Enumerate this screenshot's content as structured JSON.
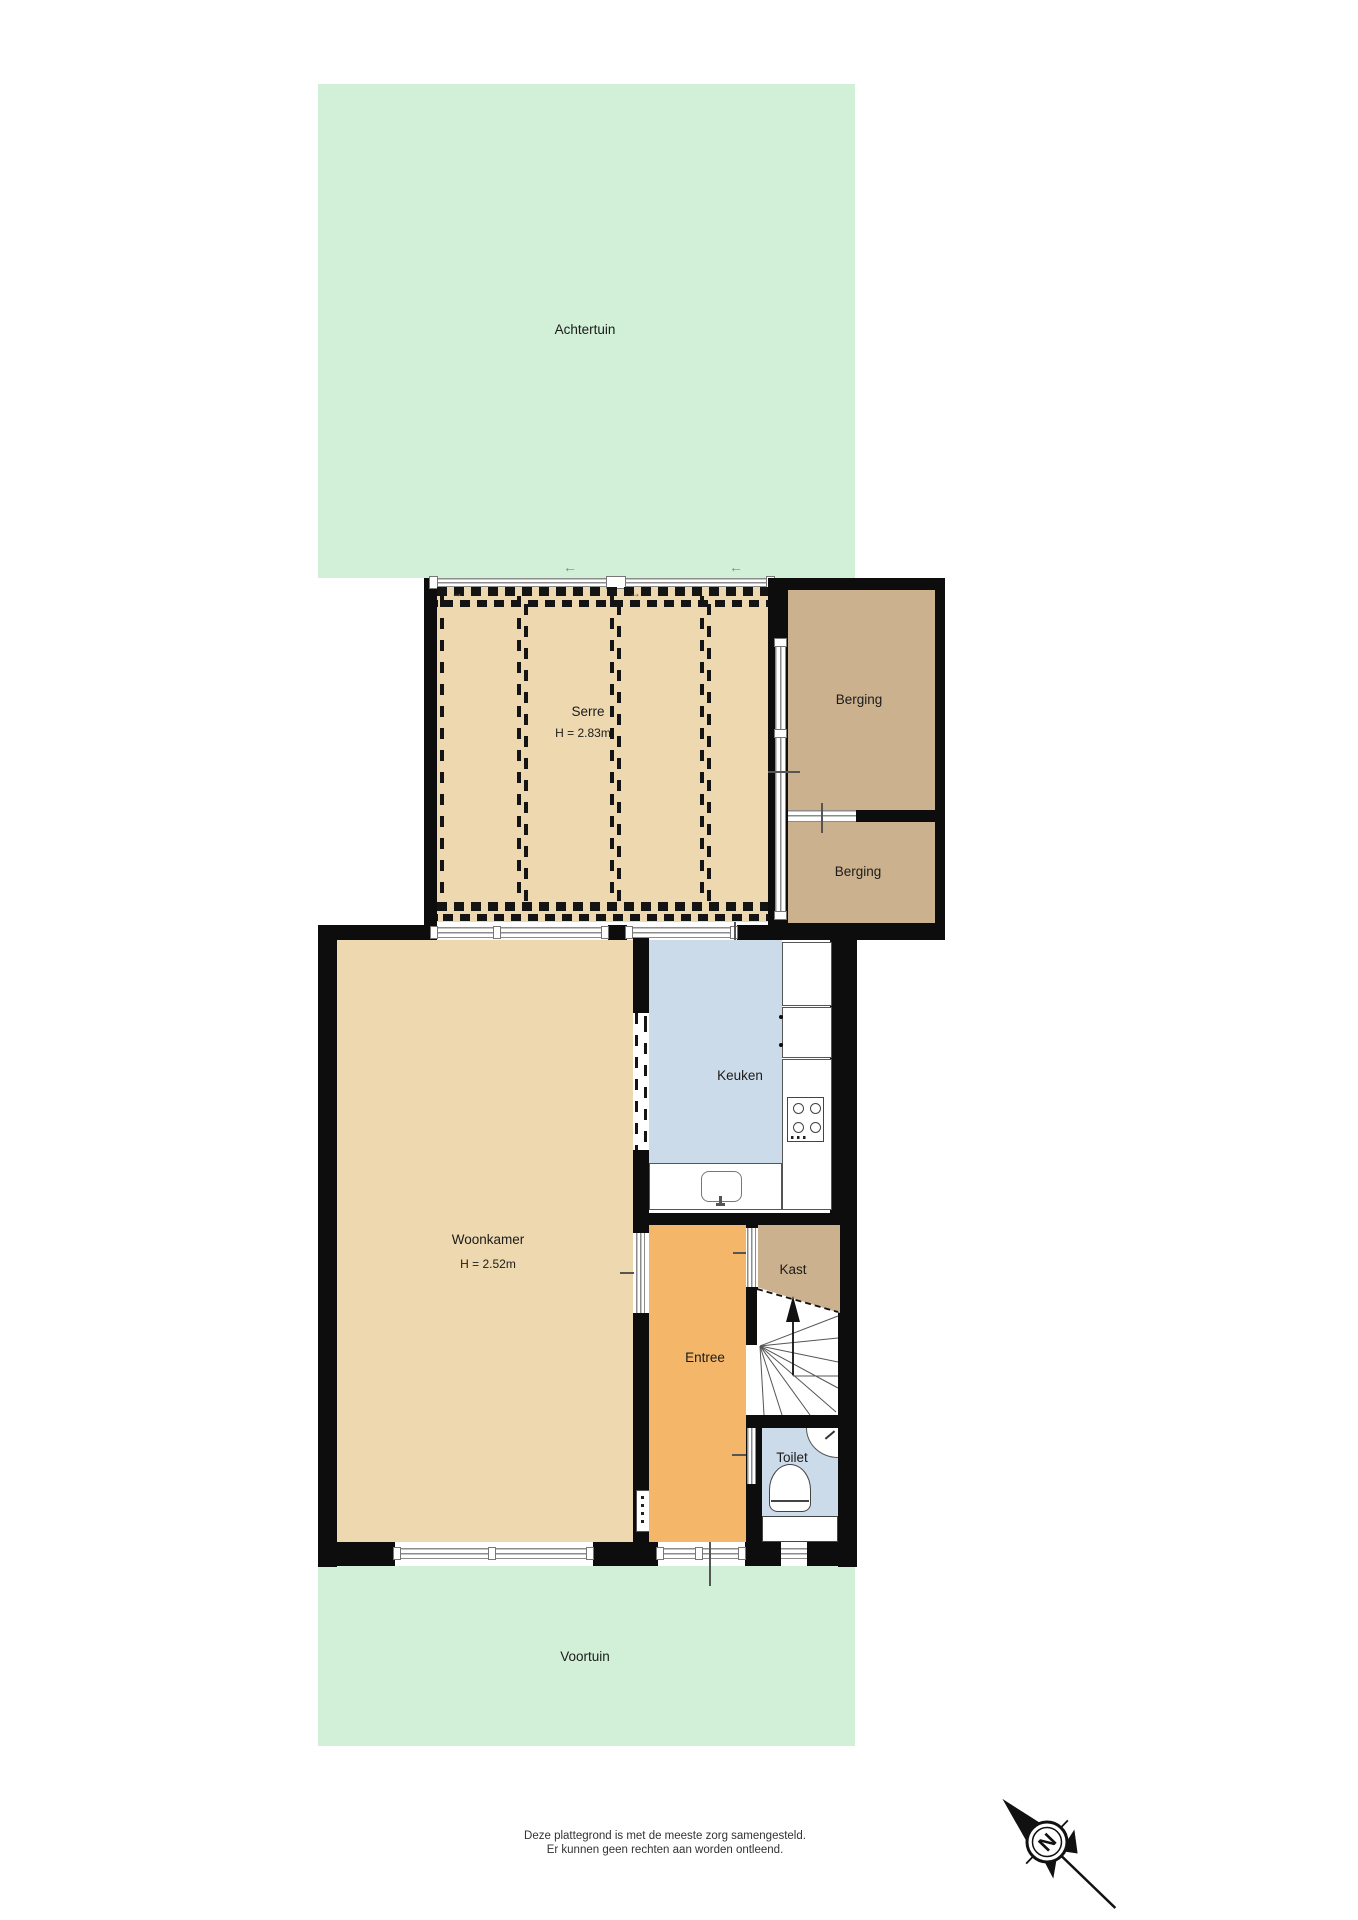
{
  "plan_title": "floor-plan-ground-floor",
  "gardens": {
    "back": "Achtertuin",
    "front": "Voortuin"
  },
  "rooms": {
    "serre": {
      "label": "Serre",
      "ceiling_height": "H = 2.83m"
    },
    "berging_top": {
      "label": "Berging"
    },
    "berging_bottom": {
      "label": "Berging"
    },
    "keuken": {
      "label": "Keuken"
    },
    "woonkamer": {
      "label": "Woonkamer",
      "ceiling_height": "H = 2.52m"
    },
    "kast": {
      "label": "Kast"
    },
    "entree": {
      "label": "Entree"
    },
    "toilet": {
      "label": "Toilet"
    }
  },
  "compass": {
    "north_letter": "N"
  },
  "footer": {
    "line1": "Deze plattegrond is met de meeste zorg samengesteld.",
    "line2": "Er kunnen geen rechten aan worden ontleend."
  },
  "colors": {
    "garden": "#d2efd7",
    "conservatory_fill": "#edd8af",
    "storage_fill": "#cbb18d",
    "kitchen_fill": "#ccdbea",
    "living_fill": "#edd8af",
    "hall_fill": "#f4b668",
    "toilet_fill": "#ccdbea",
    "wall": "#0d0d0d",
    "window_frame": "#8c8c8c"
  }
}
